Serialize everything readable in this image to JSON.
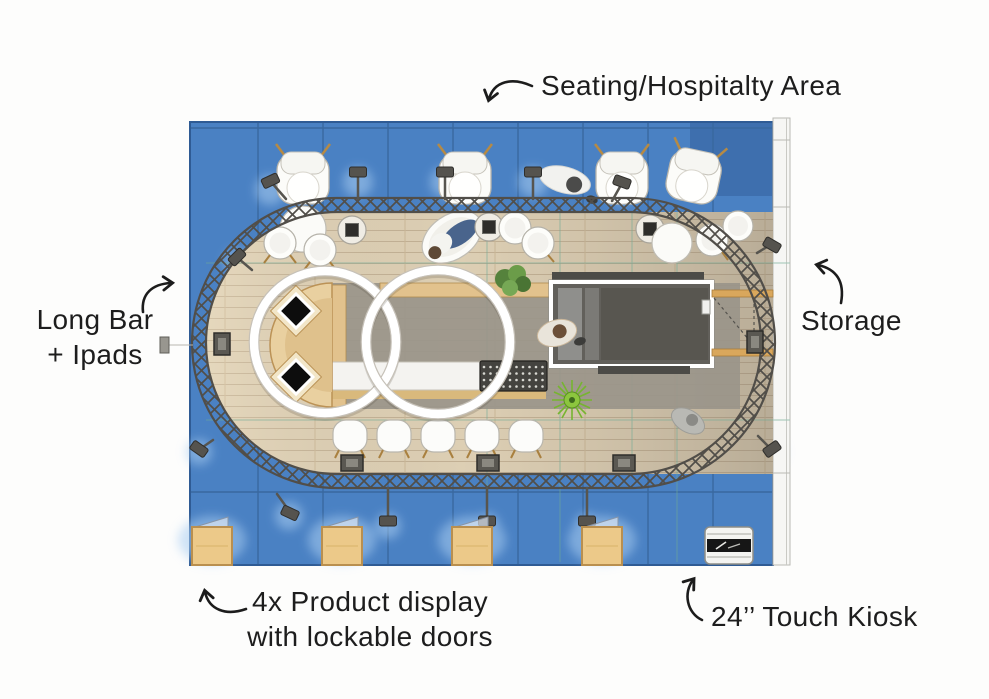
{
  "annotations": {
    "seating": {
      "label": "Seating/Hospitalty Area"
    },
    "long_bar": {
      "line1": "Long Bar",
      "line2": "+ Ipads"
    },
    "storage": {
      "label": "Storage"
    },
    "product_display": {
      "line1": "4x Product display",
      "line2": "with lockable doors"
    },
    "kiosk": {
      "label": "24’’ Touch Kiosk"
    }
  },
  "plan": {
    "colors": {
      "carpet_blue": "#4a81c3",
      "carpet_seam": "#39689f",
      "wood_light": "#e3d5ba",
      "wood_dark": "#bdb2a2",
      "counter_tan": "#e9d0a0",
      "truss_gray": "#514e49",
      "room_dark": "#62605b",
      "ring_white": "#ffffff",
      "guide_teal": "#6faa96",
      "glow_blue": "#a9cdf1",
      "annotation_ink": "#1c1c1c"
    },
    "counts": {
      "product_displays": 4,
      "bar_stools": 5,
      "hanging_rings": 2
    }
  }
}
